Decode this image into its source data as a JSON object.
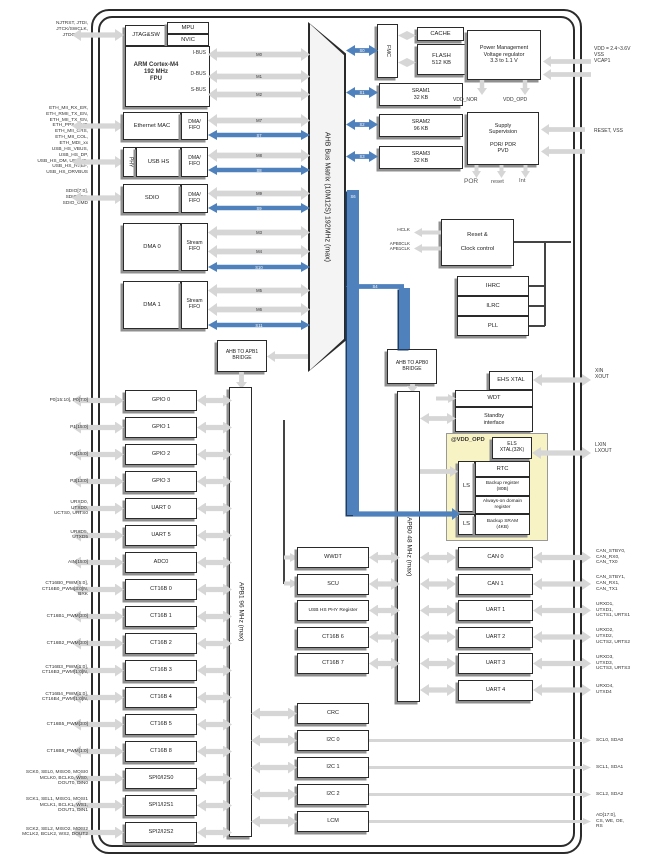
{
  "colors": {
    "bus_blue": "#4f81bd",
    "bus_gray": "#d6d6d6",
    "backup_bg": "#f8f3c5",
    "block_border": "#2a2a2a"
  },
  "cpu": {
    "jtag": "JTAG&SW",
    "mpu": "MPU",
    "nvic": "NVIC",
    "core": "ARM Cortex-M4\n192 MHz\nFPU",
    "ibus": "I-BUS",
    "dbus": "D-BUS",
    "sbus": "S-BUS"
  },
  "cpu_bus_labels": [
    "M0",
    "M1",
    "M2"
  ],
  "masters": [
    {
      "name": "Ethernet MAC",
      "fifo": "DMA/\nFIFO",
      "m": [
        "M7"
      ],
      "s": "S7"
    },
    {
      "name": "USB HS",
      "phy": "PHY",
      "fifo": "DMA/\nFIFO",
      "m": [
        "M8"
      ],
      "s": "S8"
    },
    {
      "name": "SDIO",
      "fifo": "DMA/\nFIFO",
      "m": [
        "M9"
      ],
      "s": "S9"
    },
    {
      "name": "DMA 0",
      "fifo": "Stream\nFIFO",
      "m": [
        "M3",
        "M4"
      ],
      "s": "S10"
    },
    {
      "name": "DMA 1",
      "fifo": "Stream\nFIFO",
      "m": [
        "M5",
        "M6"
      ],
      "s": "S11"
    }
  ],
  "matrix": "AHB Bus Matrix (10M12S) 192MHz (max)",
  "mem": {
    "fmc": "FMC",
    "cache": "CACHE",
    "flash": "FLASH\n512 KB",
    "sram1": "SRAM1\n32 KB",
    "sram2": "SRAM2\n96 KB",
    "sram3": "SRAM3\n32 KB",
    "s_labels": [
      "S0",
      "S1",
      "S2",
      "S3"
    ]
  },
  "power": {
    "pm": "Power Management\nVoltage regulator\n3.3 to 1.1 V",
    "vdd_nor": "VDD_NOR",
    "vdd_opd": "VDD_OPD",
    "ss": "Supply\nSupervision\n\nPOR/ PDR\nPVD",
    "por": "POR",
    "reset": "reset",
    "int": "Int"
  },
  "clock": {
    "rcc": "Reset &\n\nClock control",
    "hclk": "HCLK",
    "apbclk": "APB0CLK\nAPB1CLK",
    "ihrc": "IHRC",
    "ilrc": "ILRC",
    "pll": "PLL",
    "ehs": "EHS XTAL",
    "wdt": "WDT",
    "standby": "Standby\ninterface"
  },
  "backup": {
    "domain": "@VDD_OPD",
    "els": "ELS\nXTAL(32K)",
    "rtc": "RTC",
    "bkreg": "Backup register\n(80B)",
    "aod": "Always-on domain\nregister",
    "ls1": "LS",
    "ls2": "LS",
    "bksram": "Backup SRAM\n(4KB)"
  },
  "bridges": {
    "apb1": "AHB TO APB1\nBRIDGE",
    "apb0": "AHB TO APB0\nBRIDGE",
    "apb1bar": "APB1 96 MHz (max)",
    "apb0bar": "APB0 48 MHz (max)",
    "s_apb0": "S4",
    "s_down": "S6"
  },
  "apb1_left": [
    "GPIO 0",
    "GPIO 1",
    "GPIO 2",
    "GPIO 3",
    "UART 0",
    "UART 5",
    "ADC0",
    "CT16B 0",
    "CT16B 1",
    "CT16B 2",
    "CT16B 3",
    "CT16B 4",
    "CT16B 5",
    "CT16B 8",
    "SPI0/I2S0",
    "SPI1/I2S1",
    "SPI2/I2S2"
  ],
  "apb0_mid": [
    "WWDT",
    "SCU",
    "USB HS PHY Register",
    "CT16B 6",
    "CT16B 7"
  ],
  "apb1_mid": [
    "CRC",
    "I2C 0",
    "I2C 1",
    "I2C 2",
    "LCM"
  ],
  "apb0_right": [
    "CAN 0",
    "CAN 1",
    "UART 1",
    "UART 2",
    "UART 3",
    "UART 4"
  ],
  "pins_left_top": [
    "NJTRST, JTDI,\nJTCK/SWCLK,\nJTDO/SWO",
    "ETH_MII_RX_ER,\nETH_RMII_TX_EN,\nETH_MII_TX_EN,\nETH_PPS_OUT,\nETH_MII_CRS,\nETH_MII_COL,\nETH_MDI_xx",
    "USB_HS_VBUS,\nUSB_HS_DP,\nUSB_HS_DM, USB_ID,\nUSB_HS_RREF,\nUSB_HS_DRVBUS",
    "SDIO[7:0],\nSDIO_CK,\nSDIO_CMD"
  ],
  "pins_left": [
    "P0[15:10], P0[7:0]",
    "P1[15:0]",
    "P2[15:0]",
    "P3[13:0]",
    "URXD0,\nUTXD0,\nUCTS0, URTS0",
    "URXD5,\nUTXD5",
    "AIN[15:0]",
    "CT16B0_PWM[5:0],\nCT16B0_PWM[3:0]N,\nBRK",
    "CT16B1_PWM[3:0]",
    "CT16B2_PWM[3:0]",
    "CT16B3_PWM[1:0],\nCT16B3_PWM[1:0]N,",
    "CT16B4_PWM[1:0],\nCT16B4_PWM[1:0]N,",
    "CT16B5_PWM[3:0]",
    "CT16B8_PWM[1:0]",
    "SCK0, SEL0, MISO0, MOSI0\nMCLK0, BCLK0, WS0,\nDOUT0, DIN0",
    "SCK1, SEL1, MISO1, MOSI1\nMCLK1, BCLK1, WS1,\nDOUT1, DIN1",
    "SCK2, SEL2, MISO2, MOSI2\nMCLK2, BCLK2, WS2, DOUT2"
  ],
  "pins_right_top": [
    "VDD = 2.4~3.6V\nVSS\nVCAP1",
    "RESET, VSS"
  ],
  "pins_right_mid": [
    "XIN\nXOUT",
    "LXIN\nLXOUT"
  ],
  "pins_right": [
    "CAN_STBY0,\nCAN_RX0,\nCAN_TX0",
    "CAN_STBY1,\nCAN_RX1,\nCAN_TX1",
    "URXD1,\nUTXD1,\nUCTS1, URTS1",
    "URXD2,\nUTXD2,\nUCTS2, URTS2",
    "URXD3,\nUTXD3,\nUCTS3, URTS3",
    "URXD4,\nUTXD4"
  ],
  "pins_right_bottom": [
    "SCL0, SDA0",
    "SCL1, SDA1",
    "SCL2, SDA2",
    "AD[17:0],\nCS, WE, OE,\nRS"
  ]
}
